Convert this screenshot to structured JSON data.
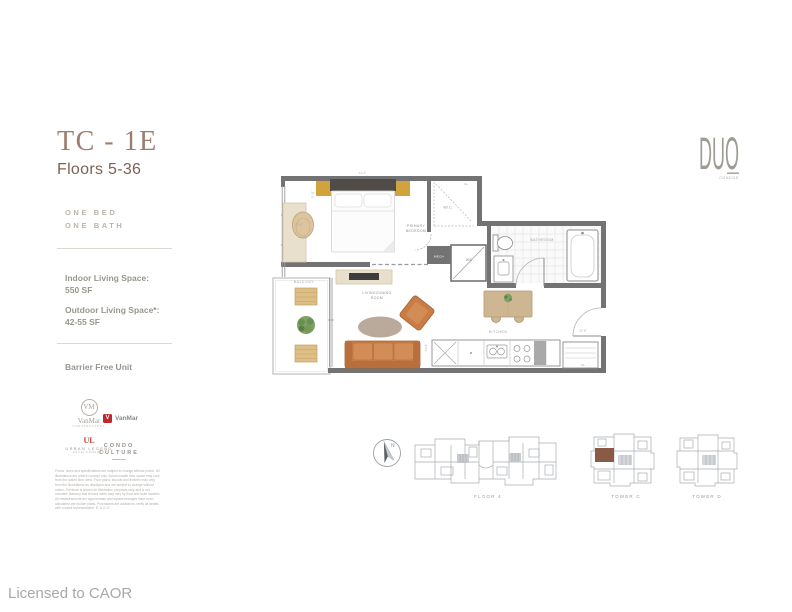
{
  "header": {
    "unit_code": "TC - 1E",
    "floors": "Floors 5-36"
  },
  "brand": {
    "name": "DUO",
    "sub": "CONDOS"
  },
  "specs": {
    "bed": "ONE BED",
    "bath": "ONE BATH",
    "indoor_label": "Indoor Living Space:",
    "indoor_value": "550 SF",
    "outdoor_label": "Outdoor Living Space*:",
    "outdoor_value": "42-55 SF",
    "feature": "Barrier Free Unit"
  },
  "partners": {
    "vanmar": {
      "monogram": "VM",
      "name": "VanMar",
      "sub": "CONSTRUCTORS"
    },
    "vanmar_red": {
      "name": "VanMar"
    },
    "urban_legend": {
      "monogram": "UL",
      "name": "URBAN LEGEND",
      "sub": "DEVELOPMENTS"
    },
    "condo_culture": {
      "line1": "CONDO",
      "line2": "CULTURE"
    }
  },
  "disclaimer": "Prices, sizes and specifications are subject to change without notice. All illustrations are artist's concept only. Actual usable floor space may vary from the stated floor area. Floor plans, layouts and finishes may vary from the illustrations as displayed and are subject to change without notice. Furniture is shown for illustration purposes only and is not included. Balcony and terrace sizes may vary by floor and suite location. All measurements are approximate and square footages have been calculated per builder plans. Purchasers are advised to verify all details with a sales representative. E. & O. E.",
  "floorplan": {
    "labels": {
      "primary_1": "PRIMARY",
      "primary_2": "BEDROOM",
      "wic": "W.I.C.",
      "cl_top": "CL",
      "cl_entry": "CL",
      "bathroom": "BATHROOM",
      "wd": "W/D",
      "mech": "MECH",
      "living_1": "LIVING/DINING",
      "living_2": "ROOM",
      "kitchen": "KITCHEN",
      "balcony": "BALCONY"
    },
    "dims": {
      "top": "11'-4\"",
      "bed_w": "13'-6\"",
      "bed_h": "9'-11\"",
      "living": "11'-6\"",
      "entry": "11'-6\""
    }
  },
  "keyplans": {
    "north": "N",
    "floor": "FLOOR 4",
    "tower_c": "TOWER C",
    "tower_d": "TOWER D"
  },
  "footer": {
    "license": "Licensed to CAOR"
  },
  "colors": {
    "accent_brown": "#9C7E6D",
    "muted_text": "#98978F",
    "wall_gray": "#737373",
    "terracotta": "#C97C45",
    "gold": "#D2A23C",
    "keyplan_highlight": "#8A5A44",
    "partner_red": "#C0272D"
  }
}
